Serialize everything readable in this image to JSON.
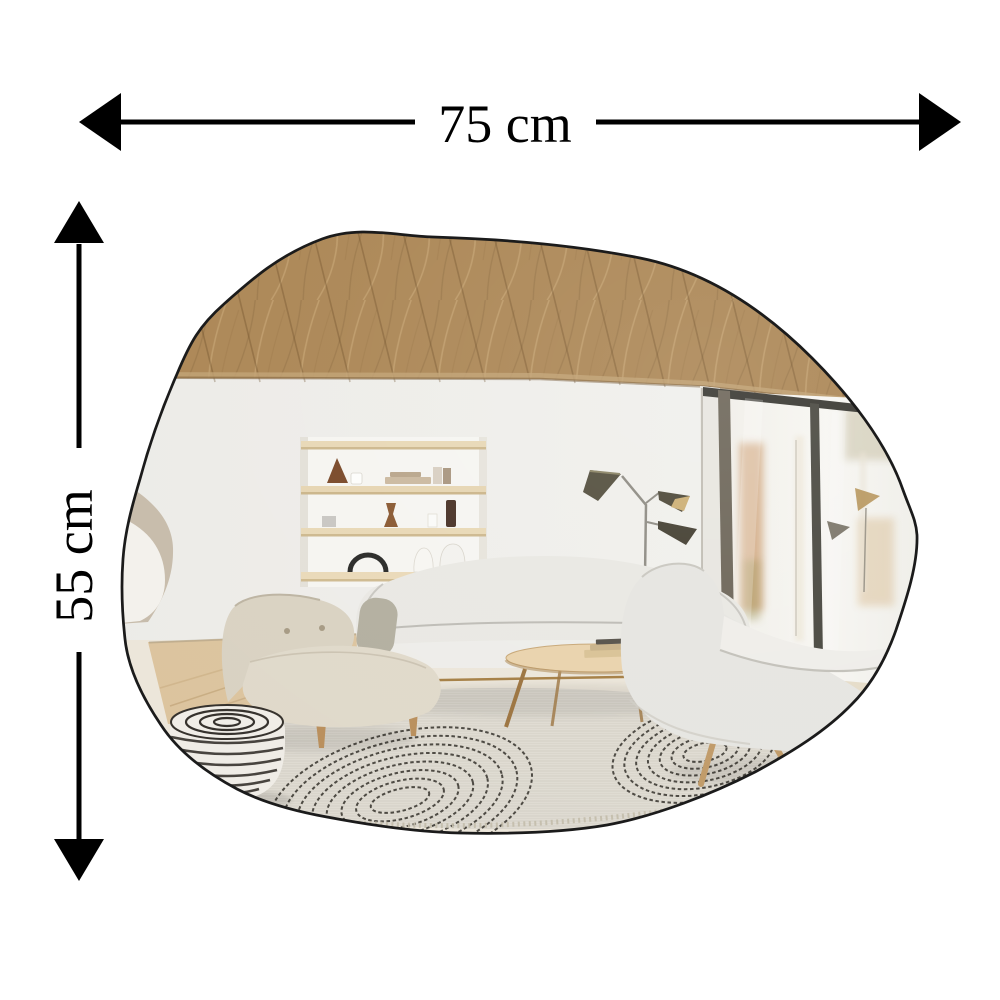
{
  "dimension_annotations": {
    "width_label": "75 cm",
    "height_label": "55 cm"
  },
  "product": {
    "name": "asymmetric organic shaped wall mirror"
  },
  "colors": {
    "annotation": "#000000",
    "mirror_edge": "#1b1b1b",
    "ceiling_wood": "#ac8756",
    "wall": "#efeeea",
    "window_frame": "#3a3933",
    "rug": "#dfdbd2",
    "rug_arc": "#33302a",
    "sofa": "#e9e8e3",
    "armchair": "#d9d2c2",
    "right_chair": "#e6e5e1",
    "pouf_base": "#efece6",
    "pouf_stripe": "#35312c",
    "wood_floor": "#dcc49e",
    "table_wood": "#e9d3ad",
    "brass": "#a57f45"
  }
}
